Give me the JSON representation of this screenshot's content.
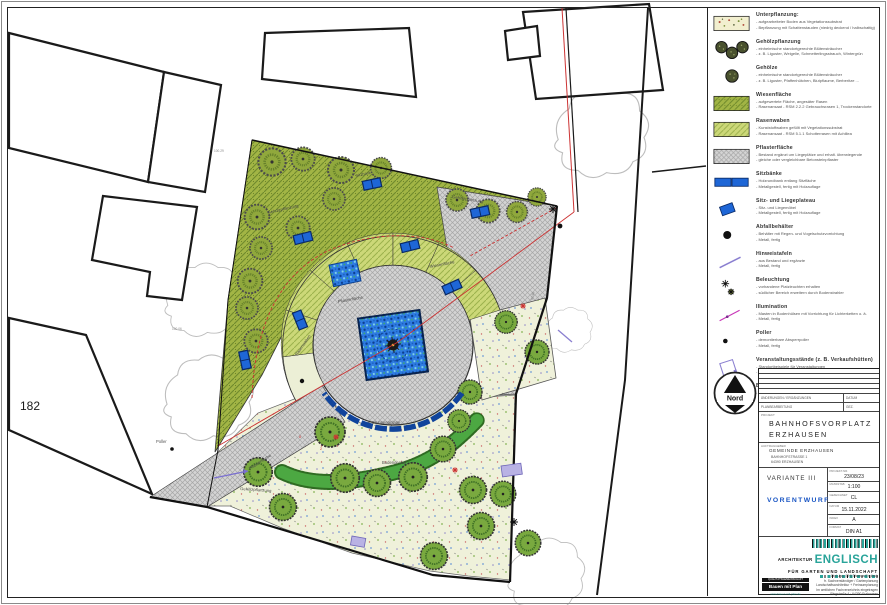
{
  "plan": {
    "labels": {
      "parcel_number": "182",
      "poller": "Poller",
      "gehoelz_top": "Gehölzpflanzung",
      "gehoelz_bottom": "Gehölzpflanzung",
      "gehoelz_right": "Gehölzpflanzung",
      "wiese": "Wiesenfläche",
      "rasenwaben": "Rasenwaben",
      "pflaster_1": "Pflasterfläche",
      "pflaster_2": "Pflasterfläche",
      "brunnen": "Brunnenanlage",
      "bodendecker": "Bodendecker",
      "sitzbank": "Sitzbank",
      "elev_1": "100.29",
      "elev_2": "100.06",
      "dim_1": "02.96",
      "tree_no_1": "8",
      "tree_no_2": "2"
    }
  },
  "legend": {
    "items": [
      {
        "name": "Unterpflanzung:",
        "line1": "- aufgearbeiteter Boden aus Vegetationssubstrat",
        "line2": "- Bepflanzung mit Schattenstauden (niedrig deckend / halbschattig)"
      },
      {
        "name": "Gehölzpflanzung",
        "line1": "- einheimische standortgerechte Blütensträucher",
        "line2": "- z. B. Liguster, Weigelie, Schmetterlingsstrauch, Wintergrün"
      },
      {
        "name": "Gehölze",
        "line1": "- einheimische standortgerechte Blütensträucher",
        "line2": "- z. B. Liguster, Pfaffenhütchen, Blutpflaume, Berberitze ..."
      },
      {
        "name": "Wiesenfläche",
        "line1": "- aufgewertete Fläche, angesäter Rasen",
        "line2": "- Rasenansaat - RSM 2.2.2 Gebrauchsrasen 1, Trockenstandorte"
      },
      {
        "name": "Rasenwaben",
        "line1": "- Kunststoffwaben gefüllt mit Vegetationssubstrat",
        "line2": "- Rasenansaat - RSM 5.1.1 Schotterrasen mit Achillea"
      },
      {
        "name": "Pflasterfläche",
        "line1": "- Bestand ergänzt um Liegeplätze und erhalt. überwiegende",
        "line2": "- gleiche oder vergleichbare Betonsteinpflaster"
      },
      {
        "name": "Sitzbänke",
        "line1": "- Holzrundbank entlang Sitzfläche",
        "line2": "- Metallgestell, fertig mit Holzauflage"
      },
      {
        "name": "Sitz- und Liegeplateau",
        "line1": "- Sitz- und Liegemöbel",
        "line2": "- Metallgestell, fertig mit Holzauflage"
      },
      {
        "name": "Abfallbehälter",
        "line1": "- Behälter mit Regen- und Vogelschutzvorrichtung",
        "line2": "- Metall, fertig"
      },
      {
        "name": "Hinweistafeln",
        "line1": "- aus Bestand und ergänzte",
        "line2": "- Metall, fertig"
      },
      {
        "name": "Beleuchtung",
        "line1": "- vorhandene Platzleuchten erhalten",
        "line2": "- südlicher Bereich erweitern durch Bodenstrahler"
      },
      {
        "name": "Illumination",
        "line1": "- Masten in Bodenhülsen mit Vorrichtung für Lichterketten o. ä.",
        "line2": "- Metall, fertig"
      },
      {
        "name": "Poller",
        "line1": "- demontierbare Absperrpoller",
        "line2": "- Metall, fertig"
      },
      {
        "name": "Veranstaltungsstände (z. B. Verkaufshütten)",
        "line1": "- Standortbeispiele für Veranstaltungen",
        "line2": "- angegliederte Bodenelektranten für Stromversorgung"
      },
      {
        "name": "Baumkataster",
        "line1": "- dokumentierte Bestandsbäume mit Nummerierung"
      }
    ]
  },
  "titleblock": {
    "north_label": "Nord",
    "rev1_left": "ÄNDERUNGEN / ERGÄNZUNGEN",
    "rev1_right": "DATUM",
    "rev2_left": "PLANBEARBEITUNG",
    "rev2_right": "GEZ.",
    "project_label": "PROJEKT",
    "title1": "BAHNHOFSVORPLATZ",
    "title2": "ERZHAUSEN",
    "client_label": "AUFTRAGGEBER",
    "client": "GEMEINDE ERZHAUSEN",
    "client_addr1": "BAHNHOFSTRASSE 1",
    "client_addr2": "64390 ERZHAUSEN",
    "variant": "VARIANTE III",
    "phase": "VORENTWURF",
    "fields": [
      {
        "label": "PROJEKT-NR.",
        "value": "23/08/23"
      },
      {
        "label": "MASSSTAB",
        "value": "1:100"
      },
      {
        "label": "GEZEICHNET",
        "value": "CL"
      },
      {
        "label": "DATUM",
        "value": "15.11.2022"
      },
      {
        "label": "INDEX",
        "value": "A"
      },
      {
        "label": "FORMAT",
        "value": "DIN A1"
      }
    ],
    "firm_top": "ARCHITEKTUR",
    "firm_name": "ENGLISCH",
    "firm_bottom": "FÜR GARTEN UND LANDSCHAFT",
    "contact": [
      "Dipl.-Ing. (FH) Thomas Englisch",
      "fr. Sachverständiger / Gartenplanung",
      "Landschaftsarchitektur + Freiraumplanung",
      "Im amtlichen Fachverzeichnis eingetragen",
      "Ringstraße 4 · 64390 Erzhausen"
    ],
    "badge_top": "QUALITÄTSGEMEINSCHAFT",
    "badge": "Bauen mit Plan",
    "badge_url": "www.bauen-mit-plan.de"
  },
  "colors": {
    "bench_blue": "#1e66d6",
    "phase_blue": "#1a56c4",
    "firm_teal": "#29a49a",
    "meadow_olive": "#a2b545",
    "waben_green": "#ccd878",
    "paving_gray": "#d4d4d4",
    "red_line": "#cc3333",
    "purple": "#8a7fd0",
    "magenta": "#c837b8"
  }
}
